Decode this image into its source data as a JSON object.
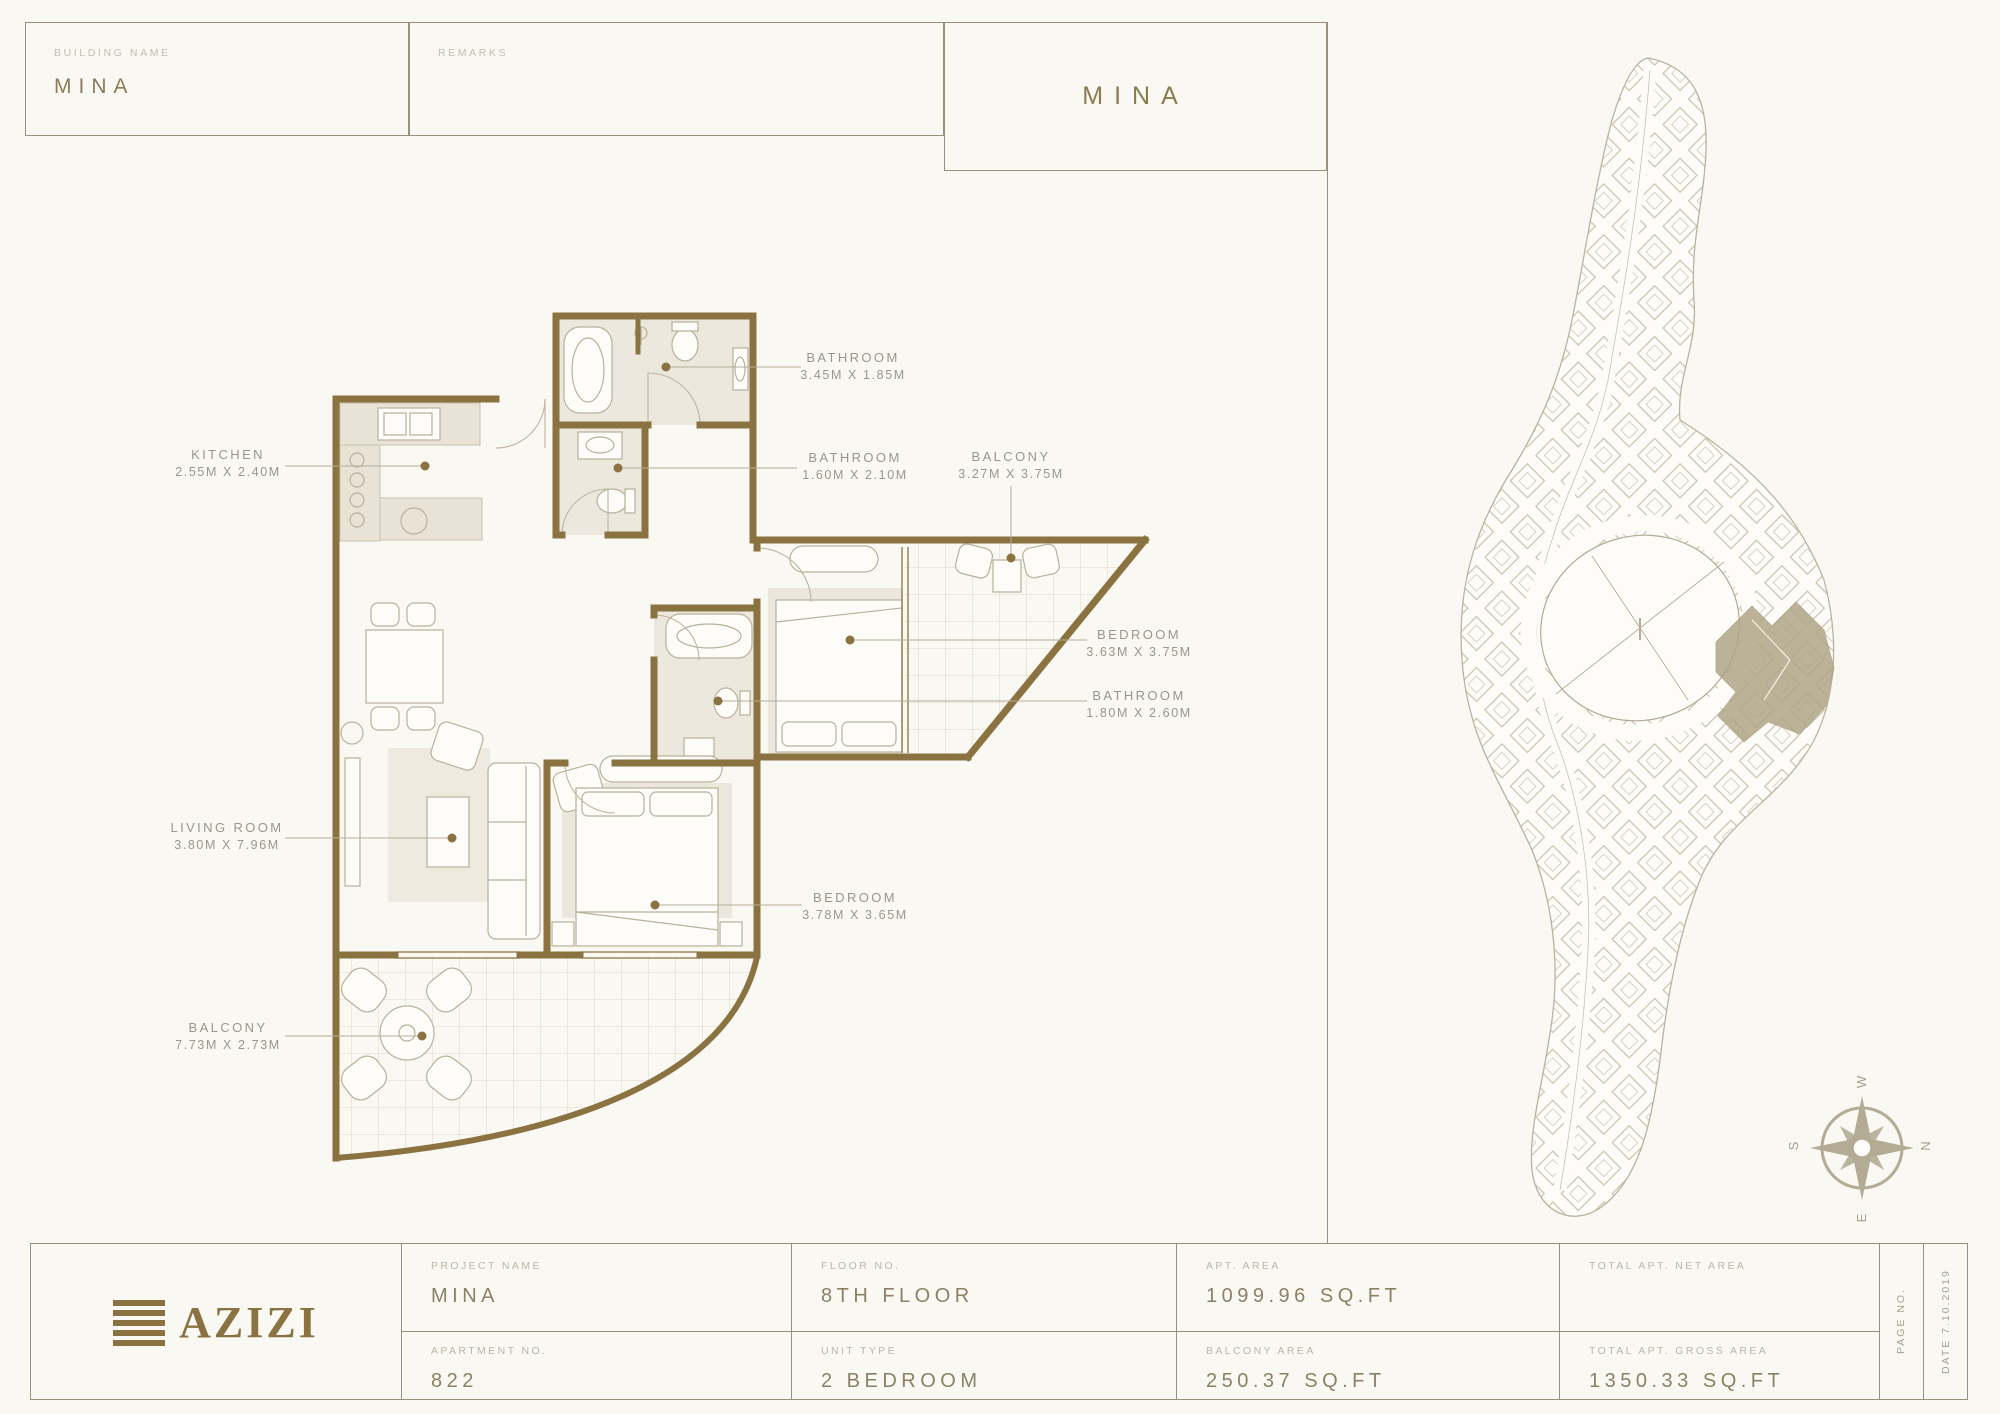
{
  "header": {
    "building_name_label": "BUILDING NAME",
    "building_name_value": "MINA",
    "remarks_label": "REMARKS",
    "plan_title": "MINA"
  },
  "plan": {
    "labels": [
      {
        "name": "KITCHEN",
        "dims": "2.55M X 2.40M"
      },
      {
        "name": "BATHROOM",
        "dims": "3.45M X 1.85M"
      },
      {
        "name": "BATHROOM",
        "dims": "1.60M X 2.10M"
      },
      {
        "name": "BALCONY",
        "dims": "3.27M X 3.75M"
      },
      {
        "name": "BEDROOM",
        "dims": "3.63M X 3.75M"
      },
      {
        "name": "BATHROOM",
        "dims": "1.80M X 2.60M"
      },
      {
        "name": "LIVING ROOM",
        "dims": "3.80M X 7.96M"
      },
      {
        "name": "BEDROOM",
        "dims": "3.78M X 3.65M"
      },
      {
        "name": "BALCONY",
        "dims": "7.73M X 2.73M"
      }
    ]
  },
  "compass": {
    "n": "N",
    "e": "E",
    "s": "S",
    "w": "W"
  },
  "footer": {
    "logo_text": "AZIZI",
    "cells": [
      {
        "label": "PROJECT NAME",
        "value": "MINA"
      },
      {
        "label": "APARTMENT NO.",
        "value": "822"
      },
      {
        "label": "FLOOR NO.",
        "value": "8TH FLOOR"
      },
      {
        "label": "UNIT TYPE",
        "value": "2 BEDROOM"
      },
      {
        "label": "APT. AREA",
        "value": "1099.96 SQ.FT"
      },
      {
        "label": "BALCONY AREA",
        "value": "250.37 SQ.FT"
      },
      {
        "label": "TOTAL APT. NET AREA",
        "value": ""
      },
      {
        "label": "TOTAL APT. GROSS AREA",
        "value": "1350.33 SQ.FT"
      }
    ],
    "page_no_label": "PAGE NO.",
    "date_label": "DATE 7.10.2019"
  },
  "colors": {
    "wall": "#8a7340",
    "accent": "#8a7340",
    "line": "#9a9078",
    "site_line": "#b3ab93",
    "highlight": "#b1a688"
  }
}
